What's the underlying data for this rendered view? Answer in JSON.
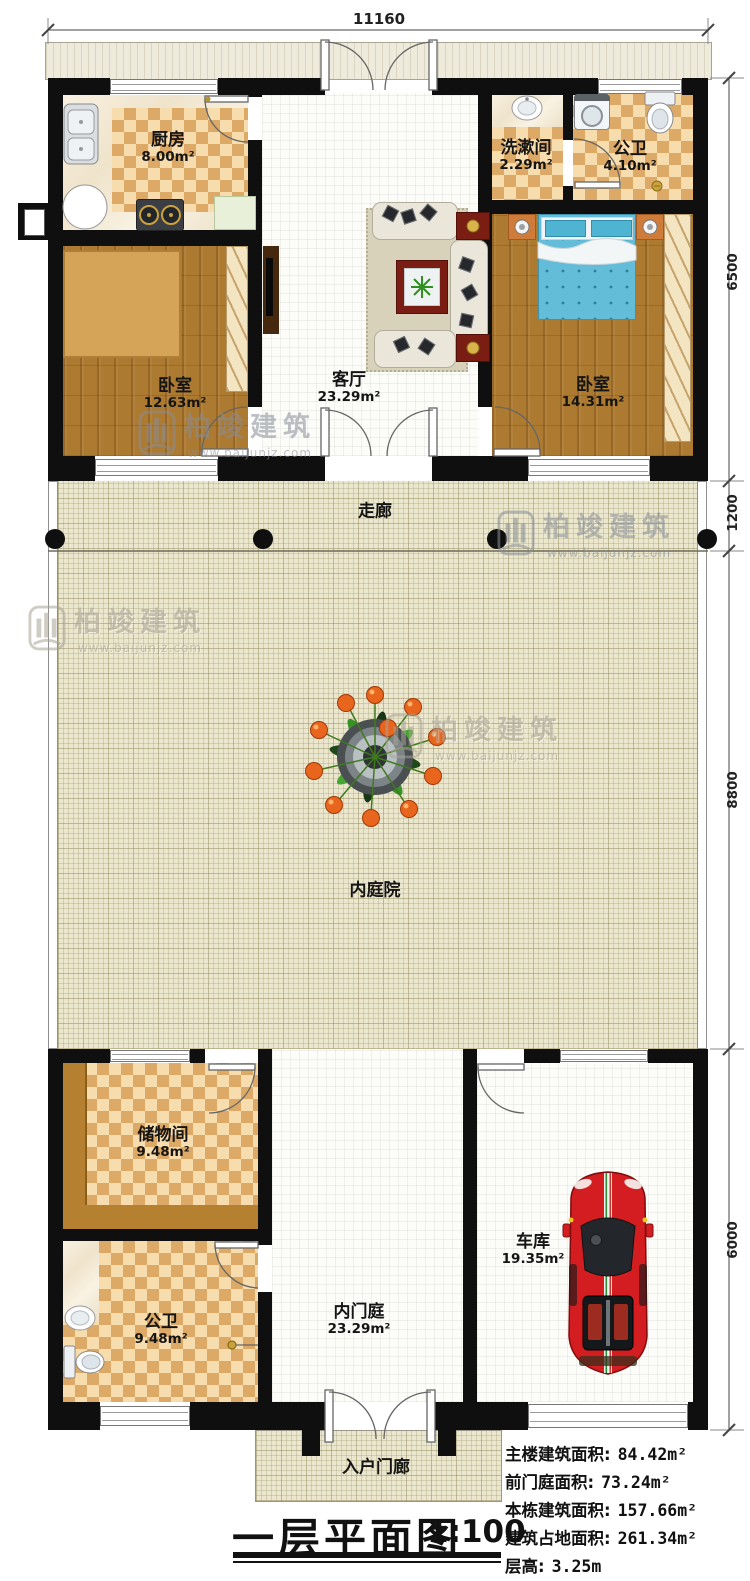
{
  "title": {
    "text": "一层平面图",
    "scale": "1:100"
  },
  "dimensions": {
    "top_width": "11160",
    "right_main_top": "6500",
    "right_corridor": "1200",
    "right_courtyard": "8800",
    "right_bottom": "6000"
  },
  "rooms": {
    "kitchen": {
      "name": "厨房",
      "area": "8.00m²"
    },
    "washroom": {
      "name": "洗漱间",
      "area": "2.29m²"
    },
    "bath_top": {
      "name": "公卫",
      "area": "4.10m²"
    },
    "bedroom_left": {
      "name": "卧室",
      "area": "12.63m²"
    },
    "living": {
      "name": "客厅",
      "area": "23.29m²"
    },
    "bedroom_right": {
      "name": "卧室",
      "area": "14.31m²"
    },
    "corridor": {
      "name": "走廊"
    },
    "courtyard": {
      "name": "内庭院"
    },
    "storage": {
      "name": "储物间",
      "area": "9.48m²"
    },
    "bath_bottom": {
      "name": "公卫",
      "area": "9.48m²"
    },
    "entry_hall": {
      "name": "内门庭",
      "area": "23.29m²"
    },
    "garage": {
      "name": "车库",
      "area": "19.35m²"
    },
    "porch": {
      "name": "入户门廊"
    }
  },
  "stats": [
    {
      "label": "主楼建筑面积:",
      "value": "84.42m²"
    },
    {
      "label": "前门庭面积:",
      "value": "73.24m²"
    },
    {
      "label": "本栋建筑面积:",
      "value": "157.66m²"
    },
    {
      "label": "建筑占地面积:",
      "value": "261.34m²"
    },
    {
      "label": "层高:",
      "value": "3.25m"
    }
  ],
  "watermark": {
    "brand": "柏竣建筑",
    "url": "www.baijunjz.com"
  },
  "colors": {
    "wall": "#0f0f0f",
    "checker_dark": "#dda967",
    "checker_light": "#f7ddae",
    "wood": "#ad7a31",
    "courtyard": "#ebe7cf",
    "table_red": "#7a1d12",
    "car_red": "#d41d20",
    "bed_blue": "#63bdd9",
    "counter_brown": "#b5802f"
  }
}
